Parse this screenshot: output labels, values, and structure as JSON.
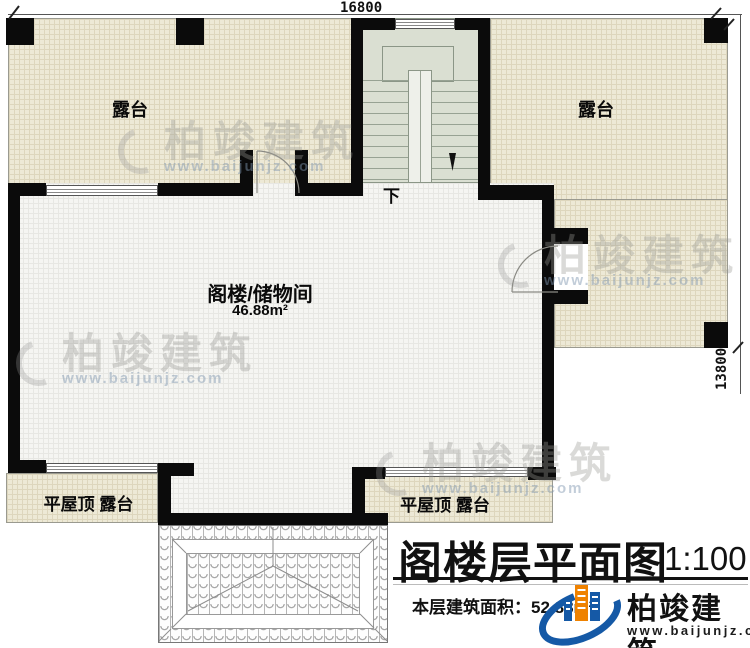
{
  "plan": {
    "dimensions": {
      "top": "16800",
      "right": "13800"
    },
    "rooms": {
      "terrace_left": "露台",
      "terrace_right": "露台",
      "attic_name": "阁楼/储物间",
      "attic_area": "46.88m²",
      "stair_down": "下",
      "flat_roof_left": "平屋顶 露台",
      "flat_roof_right": "平屋顶 露台"
    },
    "title_block": {
      "title": "阁楼层平面图",
      "scale": "1:100",
      "floor_area": "本层建筑面积：52.88m²"
    },
    "branding": {
      "name": "柏竣建筑",
      "url": "www.baijunjz.com"
    },
    "watermark": {
      "name": "柏竣建筑",
      "url": "www.baijunjz.com"
    },
    "colors": {
      "wall": "#0b0b0b",
      "terrace_floor": "#ede9d6",
      "room_floor": "#f5f5f2",
      "stair_floor": "#dadfd2",
      "logo_blue": "#1559a6",
      "logo_orange": "#ef8200"
    }
  }
}
